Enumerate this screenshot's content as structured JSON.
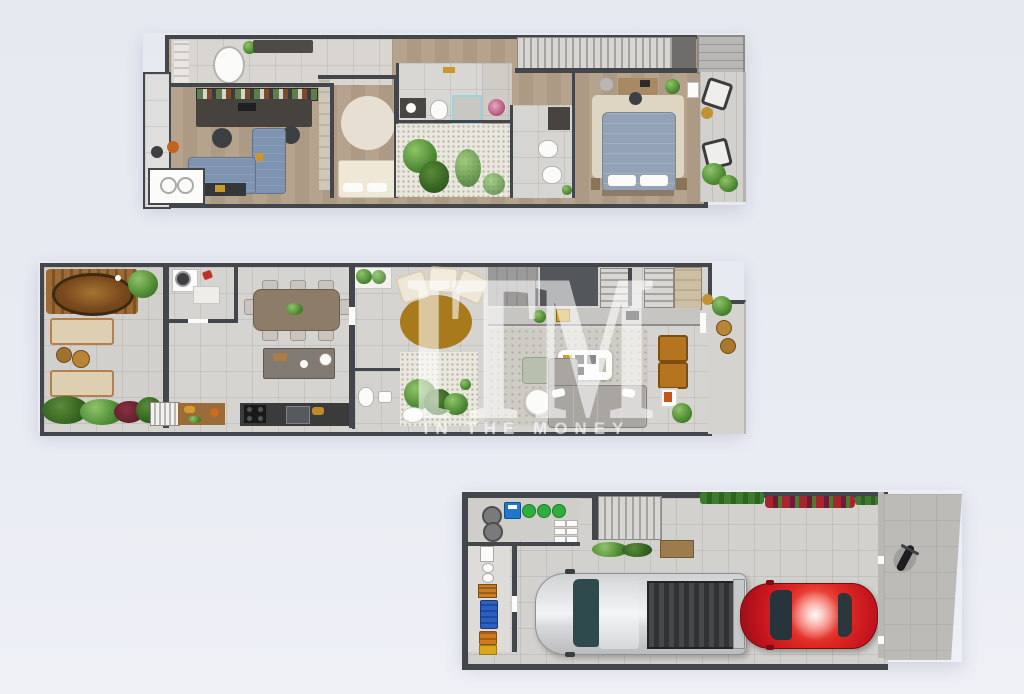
{
  "watermark": {
    "monogram": "ITM",
    "caption": "IN THE MONEY"
  },
  "palette": {
    "bgTop": "#e7e9f1",
    "bgBottom": "#eef0f6",
    "wall": "#43464b",
    "floor": "#d6d4d1",
    "wood": "#b6a38e",
    "deckWood": "#9c6b33",
    "tubWater": "#5d3a14",
    "sofaBlue": "#7e93af",
    "bedBlue": "#93a2b4",
    "rugGold": "#a87a1c",
    "caramel": "#b5741f",
    "sofaGray": "#a9a5a1",
    "green": "#4c8833",
    "greenBright": "#2fae3e",
    "carRed": "#c0131d",
    "truckSilver": "#d9dadc",
    "crateBlue": "#2b5fc0",
    "crateOrange": "#cf7a1e",
    "watermarkColor": "#ffffff"
  },
  "floors": [
    {
      "id": "upper-floor-plan"
    },
    {
      "id": "main-floor-plan"
    },
    {
      "id": "garage-level-plan"
    }
  ]
}
